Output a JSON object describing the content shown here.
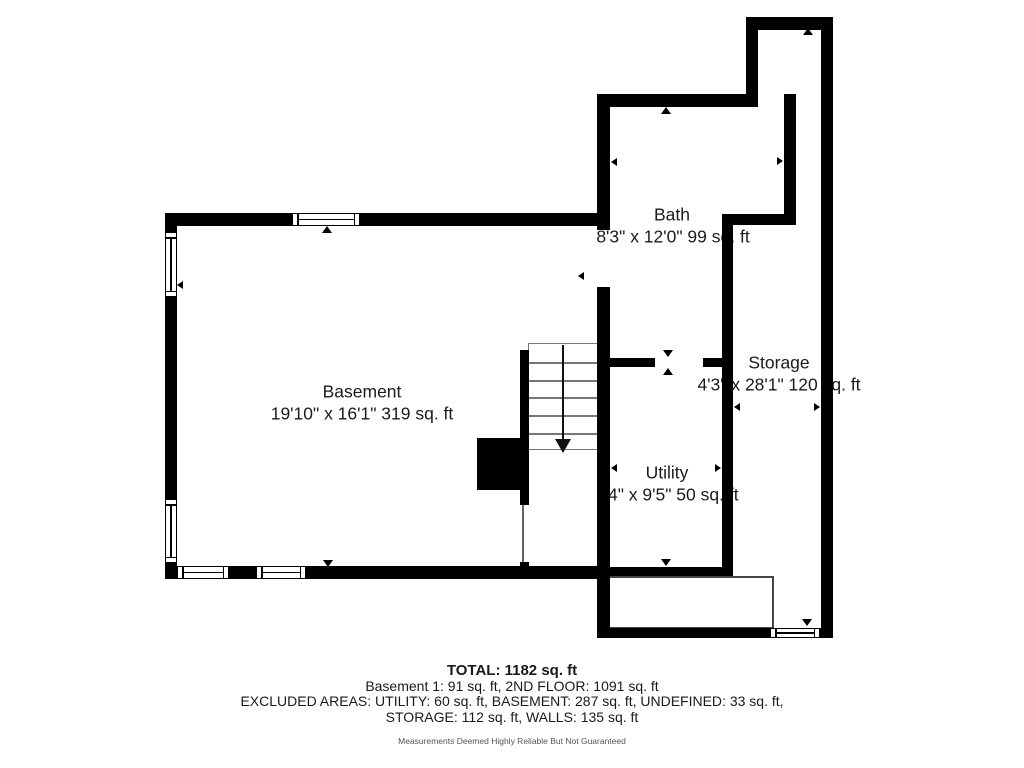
{
  "plan": {
    "rooms": [
      {
        "name": "Basement",
        "dims": "19'10\" x 16'1\" 319 sq. ft"
      },
      {
        "name": "Bath",
        "dims": "8'3\" x 12'0\" 99 sq. ft"
      },
      {
        "name": "Storage",
        "dims": "4'3\" x 28'1\" 120 sq. ft"
      },
      {
        "name": "Utility",
        "dims": "4\" x 9'5\" 50 sq. ft"
      }
    ],
    "colors": {
      "wall": "#000000",
      "background": "#ffffff",
      "stair_line": "#777777"
    }
  },
  "summary": {
    "total": "TOTAL: 1182 sq. ft",
    "line2": "Basement 1: 91 sq. ft, 2ND FLOOR: 1091 sq. ft",
    "line3": "EXCLUDED AREAS: UTILITY: 60 sq. ft, BASEMENT: 287 sq. ft, UNDEFINED: 33 sq. ft,",
    "line4": "STORAGE: 112 sq. ft, WALLS: 135 sq. ft",
    "disclaimer": "Measurements Deemed Highly Reliable But Not Guaranteed"
  }
}
